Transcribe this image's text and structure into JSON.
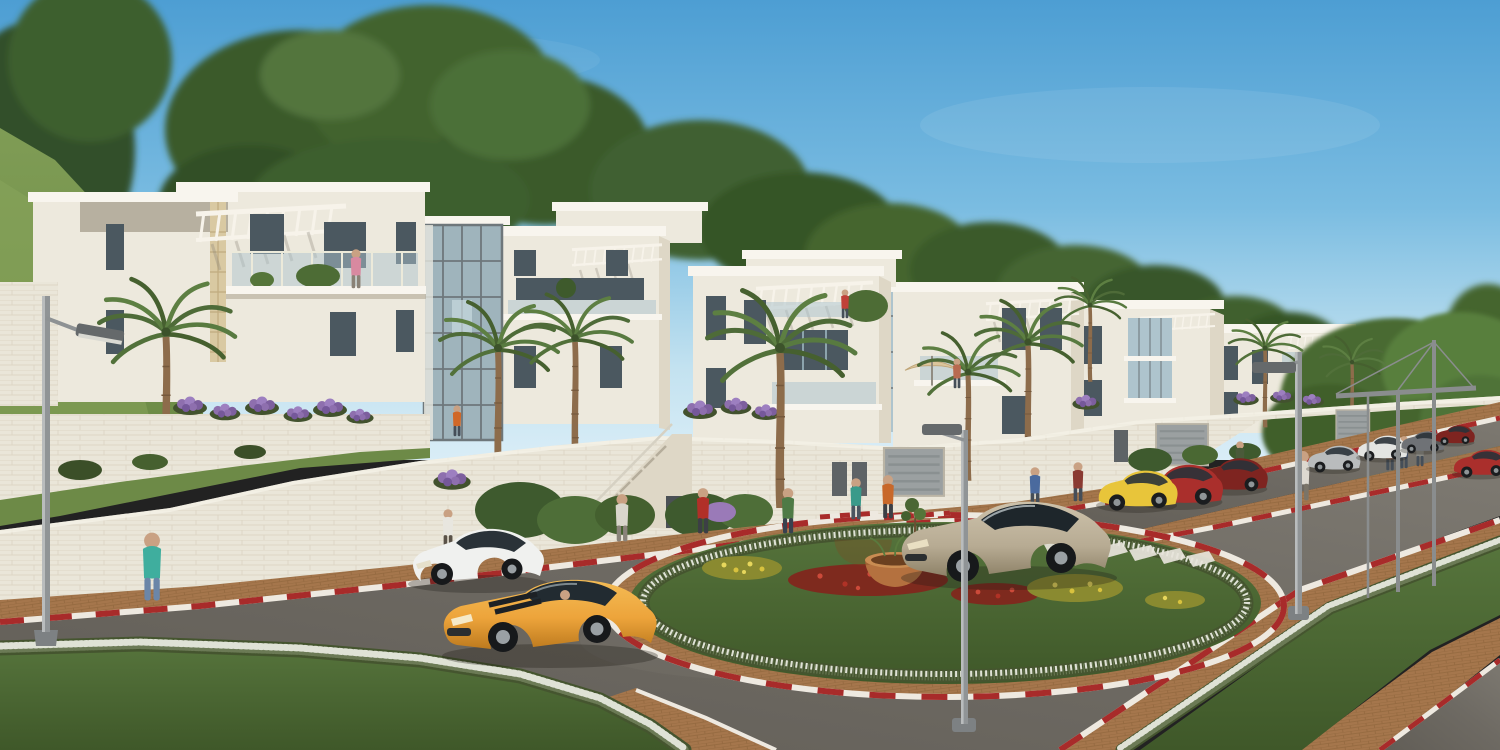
{
  "scene": {
    "alt": "Sunny architectural rendering of a hillside residential complex: a row of white stone terraced apartment buildings with rooftop pergolas, glass balconies and street-level garages, fronted by palm trees and purple terrace flowers. In the foreground a landscaped roundabout with a white flower ring, red and yellow flower beds and a terracotta planter bowl sits between asphalt roads edged with red-and-white striped curbs and brown brick sidewalks. A yellow sports coupe with black racing stripes, a white hatchback and a champagne crossover drive the roads while pedestrians walk the sidewalks under street lamps; dense green trees rise behind the buildings under a clear blue sky.",
    "setting": "hillside residential development around a landscaped roundabout, clear daytime sky",
    "palette": {
      "sky_top": "#4d9ed3",
      "sky_mid": "#7abce1",
      "sky_horizon": "#c3e2f0",
      "foliage_dark": "#31502a",
      "foliage_mid": "#42632f",
      "foliage_light": "#5d8140",
      "hill_grass": "#7f9c55",
      "grass": "#4e6a33",
      "grass_dark": "#3f5829",
      "building_light": "#ede9dd",
      "building_mid": "#ded7c6",
      "building_shadow": "#c2baa7",
      "roof_white": "#f8f5ee",
      "window_dark": "#4b5860",
      "glass_blue": "#aec4cd",
      "road": "#6e6a63",
      "road_light": "#7d7971",
      "brick": "#a5764c",
      "brick_light": "#b98a5d",
      "curb_red": "#a82b2a",
      "curb_white": "#eee9e0",
      "hedge_white": "#dfe2d6",
      "hedge_green": "#45552f",
      "flower_purple": "#8e6fae",
      "flower_red": "#b03226",
      "flower_yellow": "#d8c23e",
      "terracotta": "#b4713f",
      "car_yellow": "#eda43b",
      "car_white": "#f0f1ef",
      "car_champagne": "#b7ab93",
      "car_red": "#aa2f2c",
      "car_darkred": "#7e2420",
      "car_silver": "#b9bcbd",
      "car_gray": "#6f7276",
      "stripe_black": "#1d2125",
      "metal": "#909496",
      "skin": "#c9a183"
    },
    "elements": {
      "buildings": {
        "count": 6,
        "style": "white stone terraced apartment blocks stepping down the hill to the right",
        "features": [
          "rooftop pergola trellises",
          "glass balcony railings",
          "glass stair towers",
          "street-level garage doors",
          "purple flower planters on terrace walls"
        ]
      },
      "vegetation": {
        "palm_trees": 9,
        "background_trees": "dense green canopy behind the buildings and a large tree on the right",
        "hedges": "white flowering borders along lawns and the roundabout island",
        "terrace_flowers": "purple clusters on wall tops"
      },
      "roundabout": {
        "island": "grass ellipse ringed by white flowers",
        "flower_beds": [
          "yellow",
          "red",
          "yellow",
          "red",
          "yellow"
        ],
        "centerpiece": "terracotta planter bowl with a thin sapling",
        "ring_paving": "brown brick",
        "outer_curb": "red-white striped"
      },
      "vehicles": [
        {
          "name": "sports-coupe",
          "color_key": "car_yellow",
          "detail": "black racing stripes, driver visible"
        },
        {
          "name": "hatchback",
          "color_key": "car_white"
        },
        {
          "name": "crossover-suv",
          "color_key": "car_champagne"
        },
        {
          "name": "city-hatchback",
          "color_key": "car_yellow"
        },
        {
          "name": "sedan",
          "color_key": "car_red"
        },
        {
          "name": "coupe",
          "color_key": "car_darkred"
        },
        {
          "name": "parked-sedan",
          "color_key": "car_silver"
        },
        {
          "name": "parked-suv",
          "color_key": "car_white"
        },
        {
          "name": "parked-car",
          "color_key": "car_gray"
        },
        {
          "name": "parked-car",
          "color_key": "car_darkred"
        },
        {
          "name": "oncoming-car",
          "color_key": "car_red"
        }
      ],
      "pedestrians": {
        "count": 18,
        "locations": [
          "brick sidewalks",
          "near doorways",
          "balcony",
          "roof terraces",
          "beside parked hatchback"
        ]
      },
      "street_furniture": {
        "lamp_posts": 3,
        "cable_pergola_frames": 1
      },
      "road": {
        "surface": "asphalt",
        "curbs": "red-white striped",
        "sidewalks": "brown brick pavers",
        "crosswalk_stripes": 6
      }
    }
  }
}
